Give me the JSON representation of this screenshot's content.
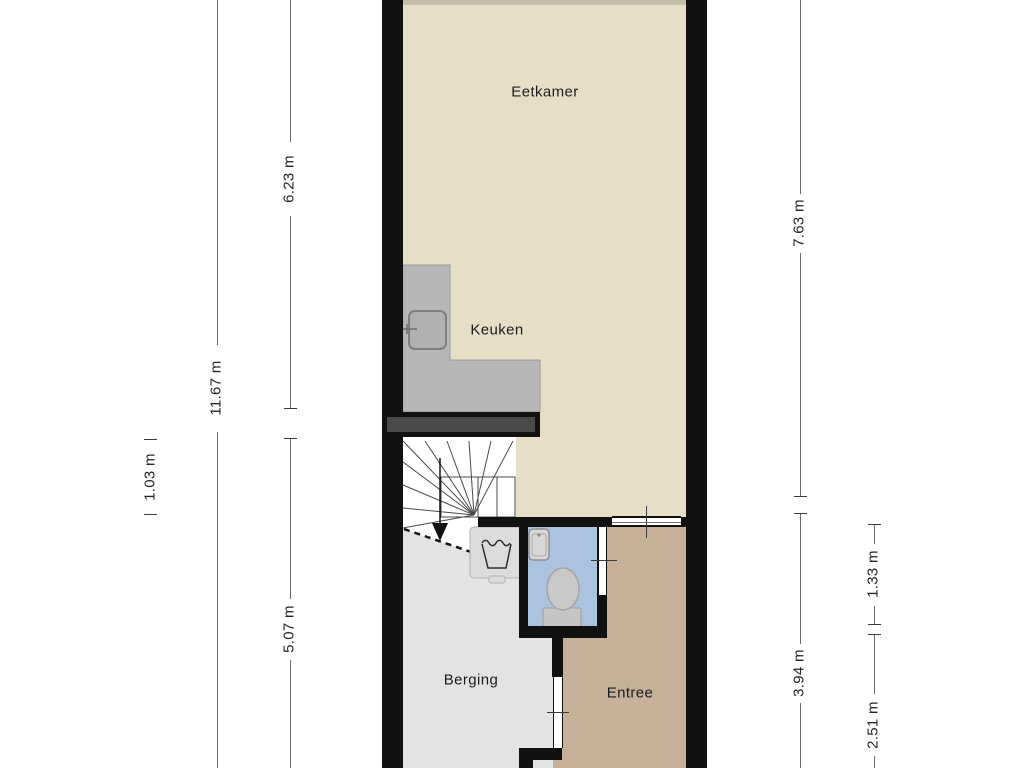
{
  "rooms": {
    "eetkamer": "Eetkamer",
    "keuken": "Keuken",
    "berging": "Berging",
    "entree": "Entree"
  },
  "dims": {
    "d623": "6.23 m",
    "d1167": "11.67 m",
    "d103": "1.03 m",
    "d507": "5.07 m",
    "d763": "7.63 m",
    "d133": "1.33 m",
    "d394": "3.94 m",
    "d251": "2.51 m"
  },
  "colors": {
    "wall": "#111111",
    "wall_inner_fill": "#4a4a4a",
    "living_floor": "#e6dfc6",
    "storage_floor": "#e3e3e3",
    "entry_floor": "#c6b098",
    "toilet_floor": "#abc3de",
    "counter": "#b7b7b7",
    "fixture_gray": "#c9c9c9",
    "dimension_line": "#6a6a6a"
  },
  "icons": [
    "stairs-icon",
    "stairs-direction-arrow-icon",
    "kitchen-counter",
    "kitchen-sink-icon",
    "washing-machine-icon",
    "toilet-icon",
    "washbasin-icon",
    "window-icon",
    "door-opening-icon"
  ]
}
